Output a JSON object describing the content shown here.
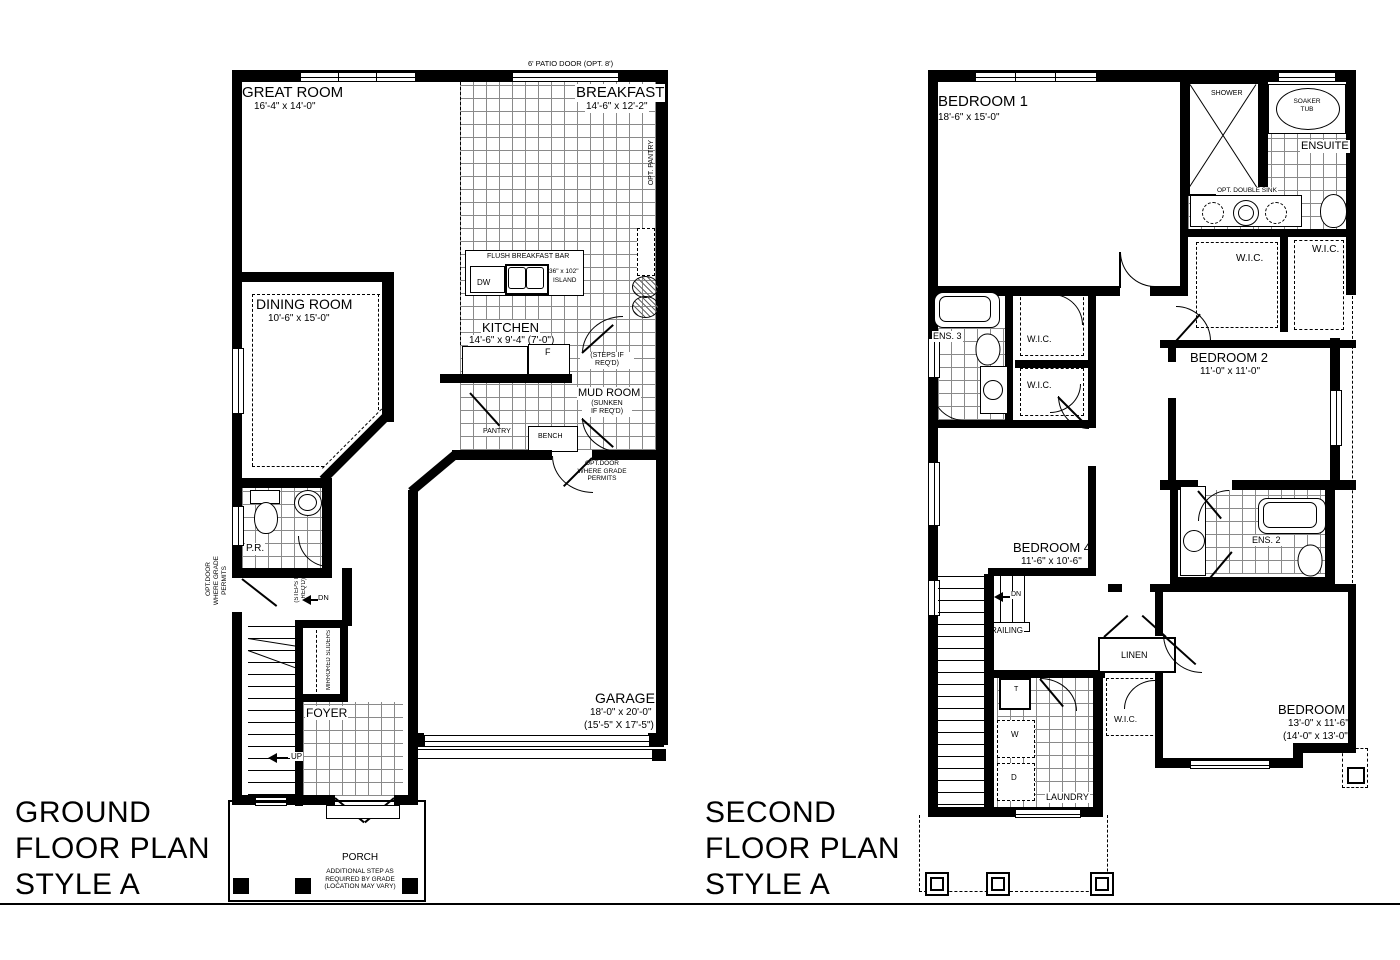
{
  "meta": {
    "paper_color": "#ffffff",
    "ink_color": "#000000"
  },
  "ground": {
    "title": [
      "GROUND",
      "FLOOR PLAN",
      "STYLE A"
    ],
    "patio_note": "6' PATIO DOOR (OPT. 8')",
    "great_room": {
      "name": "GREAT ROOM",
      "dims": "16'-4\" x 14'-0\""
    },
    "breakfast": {
      "name": "BREAKFAST",
      "dims": "14'-6\" x 12'-2\""
    },
    "opt_pantry": "OPT. PANTRY",
    "bar": {
      "label": "FLUSH BREAKFAST BAR",
      "dw": "DW",
      "island_l1": "36\" x 102\"",
      "island_l2": "ISLAND"
    },
    "kitchen": {
      "name": "KITCHEN",
      "dims": "14'-6\" x 9'-4\" (7'-0\")",
      "fridge": "F"
    },
    "steps_note": [
      "(STEPS IF",
      "REQ'D)"
    ],
    "mud_room": {
      "name": "MUD ROOM",
      "note": [
        "(SUNKEN",
        "IF REQ'D)"
      ]
    },
    "pantry": "PANTRY",
    "bench": "BENCH",
    "dining": {
      "name": "DINING ROOM",
      "dims": "10'-6\" x 15'-0\""
    },
    "powder": "P.R.",
    "opt_door": [
      "OPT.DOOR",
      "WHERE GRADE",
      "PERMITS"
    ],
    "dn": "DN",
    "up": "UP",
    "mirrored": "MIRRORED SLIDERS",
    "foyer": "FOYER",
    "garage": {
      "name": "GARAGE",
      "dims": "18'-0\" x 20'-0\"",
      "dims_alt": "(15'-5\" X 17'-5\")"
    },
    "porch": {
      "name": "PORCH",
      "note": [
        "ADDITIONAL STEP AS",
        "REQUIRED BY GRADE",
        "(LOCATION MAY VARY)"
      ]
    }
  },
  "second": {
    "title": [
      "SECOND",
      "FLOOR PLAN",
      "STYLE A"
    ],
    "bedroom1": {
      "name": "BEDROOM 1",
      "dims": "18'-6\" x 15'-0\""
    },
    "bedroom2": {
      "name": "BEDROOM 2",
      "dims": "11'-0\" x 11'-0\""
    },
    "bedroom3": {
      "name": "BEDROOM 3",
      "dims": "13'-0\" x 11'-6\"",
      "dims_alt": "(14'-0\" x 13'-0\")"
    },
    "bedroom4": {
      "name": "BEDROOM 4",
      "dims": "11'-6\" x 10'-6\""
    },
    "shower": "SHOWER",
    "soaker": [
      "SOAKER",
      "TUB"
    ],
    "ensuite": "ENSUITE",
    "opt_double_sink": "OPT. DOUBLE SINK",
    "wic": "W.I.C.",
    "ens2": "ENS. 2",
    "ens3": "ENS. 3",
    "dn": "DN",
    "railing": "RAILING",
    "linen": "LINEN",
    "laundry": {
      "name": "LAUNDRY",
      "tub": "T",
      "washer": "W",
      "dryer": "D"
    }
  }
}
